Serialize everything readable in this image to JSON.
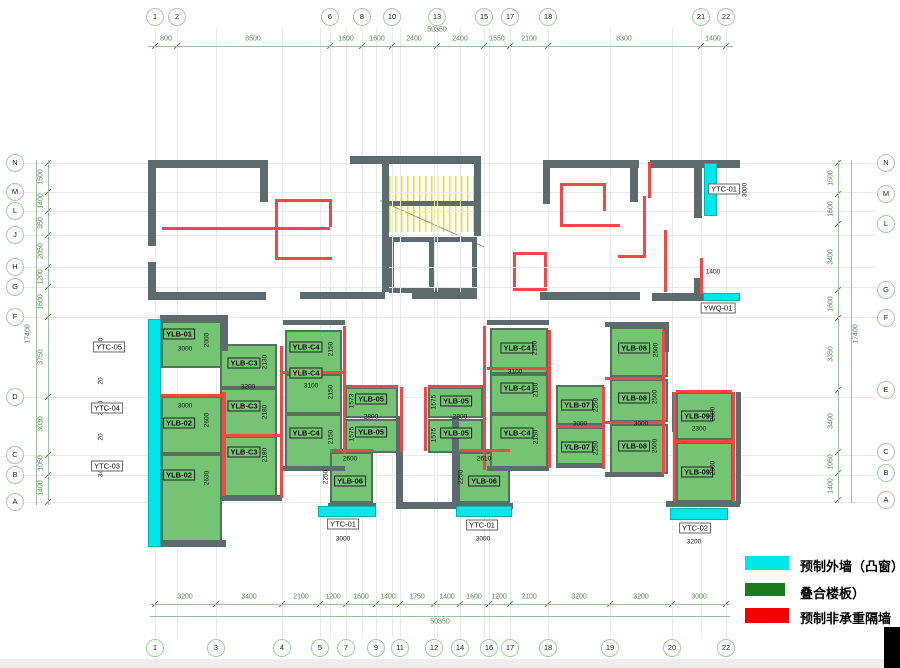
{
  "colors": {
    "precast_exterior_cyan": "#00e7e7",
    "composite_slab_green": "#74c474",
    "legend_slab_green": "#1b7a1b",
    "partition_red": "#f20000",
    "structure_wall": "#5c6b6b",
    "grid_dim_green": "#4e8a4e"
  },
  "legend": {
    "items": [
      {
        "swatch": "cyan-swatch",
        "color": "#00e7e7",
        "label": "预制外墙（凸窗）"
      },
      {
        "swatch": "green-swatch",
        "color": "#1b7a1b",
        "label": "叠合楼板）"
      },
      {
        "swatch": "red-swatch",
        "color": "#f20000",
        "label": "预制非承重隔墙"
      }
    ]
  },
  "grid": {
    "top_bubble_y": 17,
    "bottom_bubble_y": 648,
    "left_bubble_x": 15,
    "right_bubble_x": 886,
    "cols": [
      {
        "n": "1",
        "x": 155,
        "top": true,
        "bottom": true
      },
      {
        "n": "2",
        "x": 177,
        "top": true
      },
      {
        "n": "3",
        "x": 216,
        "bottom": true
      },
      {
        "n": "4",
        "x": 282,
        "bottom": true
      },
      {
        "n": "5",
        "x": 320,
        "bottom": true
      },
      {
        "n": "6",
        "x": 330,
        "top": true
      },
      {
        "n": "7",
        "x": 346,
        "bottom": true
      },
      {
        "n": "8",
        "x": 362,
        "top": true
      },
      {
        "n": "9",
        "x": 376,
        "bottom": true
      },
      {
        "n": "10",
        "x": 392,
        "top": true
      },
      {
        "n": "11",
        "x": 400,
        "bottom": true
      },
      {
        "n": "12",
        "x": 434,
        "bottom": true
      },
      {
        "n": "13",
        "x": 437,
        "top": true
      },
      {
        "n": "14",
        "x": 460,
        "bottom": true
      },
      {
        "n": "15",
        "x": 484,
        "top": true
      },
      {
        "n": "16",
        "x": 489,
        "bottom": true
      },
      {
        "n": "17",
        "x": 510,
        "top": true,
        "bottom": true
      },
      {
        "n": "18",
        "x": 548,
        "top": true,
        "bottom": true
      },
      {
        "n": "19",
        "x": 610,
        "bottom": true
      },
      {
        "n": "20",
        "x": 672,
        "bottom": true
      },
      {
        "n": "21",
        "x": 701,
        "top": true
      },
      {
        "n": "22",
        "x": 726,
        "top": true,
        "bottom": true
      }
    ],
    "rows_left": [
      {
        "n": "N",
        "y": 163
      },
      {
        "n": "M",
        "y": 192
      },
      {
        "n": "L",
        "y": 211
      },
      {
        "n": "J",
        "y": 235
      },
      {
        "n": "H",
        "y": 267
      },
      {
        "n": "G",
        "y": 287
      },
      {
        "n": "F",
        "y": 317
      },
      {
        "n": "D",
        "y": 397
      },
      {
        "n": "C",
        "y": 455
      },
      {
        "n": "B",
        "y": 475
      },
      {
        "n": "A",
        "y": 502
      }
    ],
    "rows_right": [
      {
        "n": "N",
        "y": 163
      },
      {
        "n": "M",
        "y": 194
      },
      {
        "n": "L",
        "y": 224
      },
      {
        "n": "G",
        "y": 290
      },
      {
        "n": "F",
        "y": 318
      },
      {
        "n": "E",
        "y": 390
      },
      {
        "n": "C",
        "y": 452
      },
      {
        "n": "B",
        "y": 473
      },
      {
        "n": "A",
        "y": 500
      }
    ]
  },
  "dims": {
    "top": [
      {
        "t": "800",
        "x": 166
      },
      {
        "t": "8500",
        "x": 253
      },
      {
        "t": "1600",
        "x": 346
      },
      {
        "t": "1600",
        "x": 377
      },
      {
        "t": "2400",
        "x": 414
      },
      {
        "t": "2400",
        "x": 460
      },
      {
        "t": "1550",
        "x": 497
      },
      {
        "t": "2100",
        "x": 529
      },
      {
        "t": "8300",
        "x": 624
      },
      {
        "t": "1400",
        "x": 713
      }
    ],
    "top_overall": {
      "t": "50350",
      "x": 437,
      "y": 30
    },
    "bottom": [
      {
        "t": "3200",
        "x": 185
      },
      {
        "t": "3400",
        "x": 249
      },
      {
        "t": "2100",
        "x": 301
      },
      {
        "t": "1200",
        "x": 333
      },
      {
        "t": "1600",
        "x": 361
      },
      {
        "t": "1400",
        "x": 388
      },
      {
        "t": "1750",
        "x": 417
      },
      {
        "t": "1400",
        "x": 447
      },
      {
        "t": "1600",
        "x": 474
      },
      {
        "t": "1200",
        "x": 499
      },
      {
        "t": "2100",
        "x": 529
      },
      {
        "t": "3200",
        "x": 579
      },
      {
        "t": "3200",
        "x": 641
      },
      {
        "t": "3000",
        "x": 699
      }
    ],
    "bottom_overall": {
      "t": "50350",
      "x": 440,
      "y": 622
    },
    "left": [
      {
        "t": "1500",
        "y": 177
      },
      {
        "t": "1400",
        "y": 201
      },
      {
        "t": "350",
        "y": 223
      },
      {
        "t": "2050",
        "y": 251
      },
      {
        "t": "1200",
        "y": 277
      },
      {
        "t": "1600",
        "y": 302
      },
      {
        "t": "3750",
        "y": 357
      },
      {
        "t": "3030",
        "y": 424
      },
      {
        "t": "1050",
        "y": 463
      },
      {
        "t": "1400",
        "y": 488
      }
    ],
    "left_overall": {
      "t": "17400",
      "x": 28,
      "y": 334
    },
    "right": [
      {
        "t": "1500",
        "y": 178
      },
      {
        "t": "1600",
        "y": 209
      },
      {
        "t": "3400",
        "y": 257
      },
      {
        "t": "1600",
        "y": 304
      },
      {
        "t": "3350",
        "y": 354
      },
      {
        "t": "3400",
        "y": 421
      },
      {
        "t": "1050",
        "y": 462
      },
      {
        "t": "1400",
        "y": 486
      }
    ],
    "right_overall": {
      "t": "17400",
      "x": 856,
      "y": 334
    },
    "inner_left": [
      {
        "t": "2520",
        "y": 345
      },
      {
        "t": "20",
        "y": 381
      },
      {
        "t": "3610",
        "y": 408
      },
      {
        "t": "20",
        "y": 437
      },
      {
        "t": "3450",
        "y": 470
      }
    ],
    "inner_left_x": 101
  },
  "tags": [
    {
      "t": "YTC-05",
      "x": 109,
      "y": 347
    },
    {
      "t": "YTC-04",
      "x": 107,
      "y": 408
    },
    {
      "t": "YTC-03",
      "x": 107,
      "y": 466
    },
    {
      "t": "YTC-01",
      "x": 724,
      "y": 189
    },
    {
      "t": "YWQ-01",
      "x": 718,
      "y": 308
    },
    {
      "t": "YTC-01",
      "x": 343,
      "y": 524
    },
    {
      "t": "YTC-01",
      "x": 482,
      "y": 525
    },
    {
      "t": "YTC-02",
      "x": 695,
      "y": 528
    }
  ],
  "misc_dims": [
    {
      "t": "3000",
      "x": 745,
      "y": 190,
      "rot": true
    },
    {
      "t": "1400",
      "x": 713,
      "y": 272
    },
    {
      "t": "3000",
      "x": 343,
      "y": 539
    },
    {
      "t": "3000",
      "x": 483,
      "y": 539
    },
    {
      "t": "3200",
      "x": 694,
      "y": 542
    }
  ],
  "panels": [
    {
      "label": "YLB-01",
      "x": 161,
      "y": 321,
      "w": 61,
      "h": 47,
      "lx": 179,
      "ly": 334,
      "dims": [
        {
          "t": "3000",
          "x": 185,
          "y": 349
        },
        {
          "t": "2000",
          "x": 207,
          "y": 340,
          "rot": true
        }
      ]
    },
    {
      "label": "YLB-02",
      "x": 161,
      "y": 396,
      "w": 61,
      "h": 58,
      "lx": 179,
      "ly": 423,
      "dims": [
        {
          "t": "3000",
          "x": 185,
          "y": 406
        },
        {
          "t": "2600",
          "x": 207,
          "y": 420,
          "rot": true
        }
      ]
    },
    {
      "label": "YLB-02",
      "x": 161,
      "y": 454,
      "w": 61,
      "h": 90,
      "lx": 179,
      "ly": 475,
      "dims": [
        {
          "t": "2630",
          "x": 207,
          "y": 478,
          "rot": true
        }
      ]
    },
    {
      "label": "YLB-C3",
      "x": 220,
      "y": 344,
      "w": 57,
      "h": 44,
      "lx": 244,
      "ly": 363,
      "dims": [
        {
          "t": "2130",
          "x": 265,
          "y": 362,
          "rot": true
        }
      ]
    },
    {
      "label": "YLB-C3",
      "x": 220,
      "y": 388,
      "w": 57,
      "h": 48,
      "lx": 244,
      "ly": 406,
      "dims": [
        {
          "t": "3200",
          "x": 248,
          "y": 387
        },
        {
          "t": "2180",
          "x": 265,
          "y": 412,
          "rot": true
        }
      ]
    },
    {
      "label": "YLB-C3",
      "x": 220,
      "y": 436,
      "w": 57,
      "h": 62,
      "lx": 244,
      "ly": 452,
      "dims": [
        {
          "t": "2180",
          "x": 265,
          "y": 455,
          "rot": true
        }
      ]
    },
    {
      "label": "YLB-C4",
      "x": 285,
      "y": 330,
      "w": 57,
      "h": 44,
      "lx": 306,
      "ly": 347,
      "dims": [
        {
          "t": "2150",
          "x": 331,
          "y": 349,
          "rot": true
        }
      ]
    },
    {
      "label": "YLB-C4",
      "x": 285,
      "y": 374,
      "w": 57,
      "h": 40,
      "lx": 306,
      "ly": 373,
      "dims": [
        {
          "t": "3100",
          "x": 311,
          "y": 386
        },
        {
          "t": "2150",
          "x": 331,
          "y": 392,
          "rot": true
        }
      ]
    },
    {
      "label": "YLB-C4",
      "x": 285,
      "y": 414,
      "w": 57,
      "h": 54,
      "lx": 306,
      "ly": 433,
      "dims": [
        {
          "t": "2150",
          "x": 331,
          "y": 437,
          "rot": true
        }
      ]
    },
    {
      "label": "YLB-05",
      "x": 345,
      "y": 387,
      "w": 53,
      "h": 31,
      "lx": 371,
      "ly": 399,
      "dims": [
        {
          "t": "1573",
          "x": 352,
          "y": 401,
          "rot": true
        },
        {
          "t": "2800",
          "x": 371,
          "y": 417
        }
      ]
    },
    {
      "label": "YLB-05",
      "x": 345,
      "y": 419,
      "w": 53,
      "h": 34,
      "lx": 371,
      "ly": 432,
      "dims": [
        {
          "t": "1575",
          "x": 352,
          "y": 434,
          "rot": true
        }
      ]
    },
    {
      "label": "YLB-06",
      "x": 330,
      "y": 452,
      "w": 43,
      "h": 51,
      "lx": 350,
      "ly": 481,
      "dims": [
        {
          "t": "2600",
          "x": 350,
          "y": 459
        },
        {
          "t": "2250",
          "x": 326,
          "y": 477,
          "rot": true
        }
      ]
    },
    {
      "label": "YLB-05",
      "x": 428,
      "y": 387,
      "w": 55,
      "h": 31,
      "lx": 456,
      "ly": 401,
      "dims": [
        {
          "t": "1575",
          "x": 434,
          "y": 402,
          "rot": true
        },
        {
          "t": "2800",
          "x": 460,
          "y": 417
        }
      ]
    },
    {
      "label": "YLB-05",
      "x": 428,
      "y": 419,
      "w": 55,
      "h": 34,
      "lx": 456,
      "ly": 433,
      "dims": [
        {
          "t": "1575",
          "x": 434,
          "y": 435,
          "rot": true
        }
      ]
    },
    {
      "label": "YLB-06",
      "x": 458,
      "y": 452,
      "w": 52,
      "h": 51,
      "lx": 484,
      "ly": 481,
      "dims": [
        {
          "t": "2610",
          "x": 484,
          "y": 459
        },
        {
          "t": "2250",
          "x": 461,
          "y": 477,
          "rot": true
        }
      ]
    },
    {
      "label": "YLB-C4",
      "x": 490,
      "y": 328,
      "w": 58,
      "h": 46,
      "lx": 517,
      "ly": 348,
      "dims": [
        {
          "t": "2150",
          "x": 535,
          "y": 348,
          "rot": true
        }
      ]
    },
    {
      "label": "YLB-C4",
      "x": 490,
      "y": 374,
      "w": 58,
      "h": 40,
      "lx": 517,
      "ly": 388,
      "dims": [
        {
          "t": "3100",
          "x": 515,
          "y": 372
        },
        {
          "t": "2150",
          "x": 536,
          "y": 390,
          "rot": true
        }
      ]
    },
    {
      "label": "YLB-C4",
      "x": 490,
      "y": 414,
      "w": 58,
      "h": 54,
      "lx": 517,
      "ly": 433,
      "dims": [
        {
          "t": "2150",
          "x": 536,
          "y": 437,
          "rot": true
        }
      ]
    },
    {
      "label": "YLB-07",
      "x": 556,
      "y": 385,
      "w": 48,
      "h": 40,
      "lx": 577,
      "ly": 405,
      "dims": [
        {
          "t": "2250",
          "x": 596,
          "y": 405,
          "rot": true
        },
        {
          "t": "3000",
          "x": 580,
          "y": 424
        }
      ]
    },
    {
      "label": "YLB-07",
      "x": 556,
      "y": 427,
      "w": 48,
      "h": 38,
      "lx": 577,
      "ly": 447,
      "dims": [
        {
          "t": "2250",
          "x": 596,
          "y": 448,
          "rot": true
        }
      ]
    },
    {
      "label": "YLB-08",
      "x": 610,
      "y": 327,
      "w": 58,
      "h": 50,
      "lx": 634,
      "ly": 348,
      "dims": [
        {
          "t": "2500",
          "x": 656,
          "y": 350,
          "rot": true
        }
      ]
    },
    {
      "label": "YLB-08",
      "x": 610,
      "y": 379,
      "w": 58,
      "h": 43,
      "lx": 634,
      "ly": 398,
      "dims": [
        {
          "t": "2500",
          "x": 655,
          "y": 397,
          "rot": true
        },
        {
          "t": "3000",
          "x": 641,
          "y": 424
        }
      ]
    },
    {
      "label": "YLB-08",
      "x": 610,
      "y": 424,
      "w": 58,
      "h": 50,
      "lx": 634,
      "ly": 446,
      "dims": [
        {
          "t": "2500",
          "x": 655,
          "y": 446,
          "rot": true
        }
      ]
    },
    {
      "label": "YLB-09",
      "x": 676,
      "y": 392,
      "w": 57,
      "h": 48,
      "lx": 697,
      "ly": 416,
      "dims": [
        {
          "t": "2300",
          "x": 699,
          "y": 429
        },
        {
          "t": "2800",
          "x": 713,
          "y": 414,
          "rot": true
        }
      ]
    },
    {
      "label": "YLB-09",
      "x": 676,
      "y": 442,
      "w": 57,
      "h": 60,
      "lx": 697,
      "ly": 472,
      "dims": [
        {
          "t": "2800",
          "x": 713,
          "y": 468,
          "rot": true
        }
      ]
    }
  ],
  "cyan_walls": [
    {
      "x": 148,
      "y": 319,
      "w": 13,
      "h": 228
    },
    {
      "x": 704,
      "y": 163,
      "w": 13,
      "h": 53
    },
    {
      "x": 703,
      "y": 293,
      "w": 37,
      "h": 8
    },
    {
      "x": 318,
      "y": 506,
      "w": 58,
      "h": 11
    },
    {
      "x": 456,
      "y": 506,
      "w": 56,
      "h": 11
    },
    {
      "x": 670,
      "y": 508,
      "w": 58,
      "h": 12
    }
  ],
  "walls": [
    [
      148,
      160,
      120,
      8
    ],
    [
      350,
      156,
      131,
      8
    ],
    [
      543,
      160,
      96,
      8
    ],
    [
      650,
      160,
      90,
      8
    ],
    [
      148,
      168,
      8,
      78
    ],
    [
      148,
      262,
      8,
      38
    ],
    [
      260,
      160,
      8,
      42
    ],
    [
      382,
      156,
      7,
      136
    ],
    [
      474,
      156,
      7,
      80
    ],
    [
      543,
      160,
      7,
      44
    ],
    [
      630,
      160,
      8,
      42
    ],
    [
      694,
      163,
      8,
      55
    ],
    [
      694,
      278,
      8,
      22
    ],
    [
      148,
      292,
      118,
      8
    ],
    [
      300,
      292,
      85,
      7
    ],
    [
      412,
      292,
      65,
      7
    ],
    [
      540,
      292,
      100,
      8
    ],
    [
      652,
      293,
      88,
      8
    ],
    [
      160,
      315,
      64,
      6
    ],
    [
      222,
      315,
      6,
      36
    ],
    [
      283,
      320,
      62,
      5
    ],
    [
      487,
      320,
      62,
      5
    ],
    [
      605,
      322,
      59,
      5
    ],
    [
      663,
      322,
      6,
      30
    ],
    [
      672,
      392,
      6,
      40
    ],
    [
      736,
      392,
      5,
      112
    ],
    [
      396,
      416,
      7,
      92
    ],
    [
      452,
      416,
      7,
      92
    ],
    [
      396,
      502,
      63,
      7
    ],
    [
      328,
      503,
      48,
      6
    ],
    [
      456,
      503,
      57,
      6
    ],
    [
      666,
      501,
      74,
      6
    ],
    [
      148,
      540,
      78,
      7
    ],
    [
      222,
      495,
      60,
      6
    ],
    [
      283,
      466,
      62,
      5
    ],
    [
      487,
      466,
      62,
      5
    ],
    [
      556,
      463,
      48,
      5
    ],
    [
      605,
      472,
      59,
      5
    ]
  ],
  "reds": [
    [
      162,
      227,
      168,
      3
    ],
    [
      275,
      199,
      57,
      3
    ],
    [
      275,
      199,
      3,
      61
    ],
    [
      275,
      257,
      57,
      3
    ],
    [
      329,
      199,
      3,
      28
    ],
    [
      560,
      183,
      3,
      44
    ],
    [
      560,
      183,
      46,
      3
    ],
    [
      603,
      183,
      3,
      28
    ],
    [
      560,
      224,
      60,
      3
    ],
    [
      643,
      196,
      3,
      62
    ],
    [
      618,
      255,
      27,
      3
    ],
    [
      648,
      162,
      3,
      36
    ],
    [
      664,
      230,
      3,
      62
    ],
    [
      700,
      258,
      3,
      36
    ],
    [
      222,
      392,
      4,
      104
    ],
    [
      280,
      346,
      3,
      152
    ],
    [
      343,
      326,
      3,
      128
    ],
    [
      400,
      387,
      3,
      64
    ],
    [
      424,
      387,
      3,
      64
    ],
    [
      483,
      326,
      3,
      144
    ],
    [
      548,
      330,
      3,
      138
    ],
    [
      602,
      387,
      3,
      82
    ],
    [
      662,
      330,
      3,
      144
    ],
    [
      673,
      392,
      3,
      110
    ],
    [
      732,
      392,
      3,
      110
    ],
    [
      160,
      394,
      62,
      3
    ],
    [
      224,
      434,
      56,
      3
    ],
    [
      283,
      371,
      60,
      3
    ],
    [
      345,
      385,
      53,
      3
    ],
    [
      428,
      385,
      55,
      3
    ],
    [
      330,
      449,
      44,
      3
    ],
    [
      458,
      449,
      52,
      3
    ],
    [
      487,
      367,
      60,
      3
    ],
    [
      556,
      425,
      46,
      3
    ],
    [
      605,
      377,
      57,
      3
    ],
    [
      605,
      421,
      57,
      3
    ],
    [
      676,
      390,
      56,
      3
    ],
    [
      676,
      440,
      56,
      3
    ]
  ]
}
